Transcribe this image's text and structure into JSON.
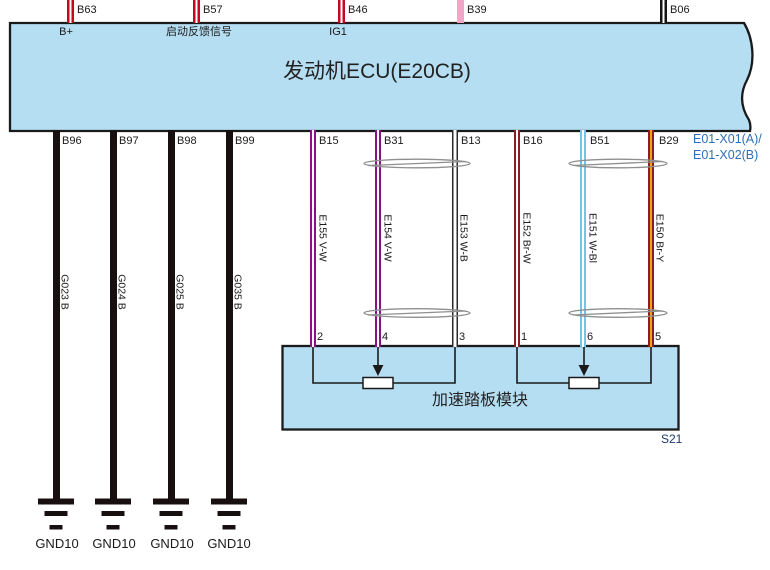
{
  "diagram": {
    "ecu": {
      "title": "发动机ECU(E20CB)",
      "connector_label": [
        "E01-X01(A)/",
        "E01-X02(B)"
      ]
    },
    "top_pins": [
      {
        "pin": "B63",
        "function": "B+",
        "wire_color": "red"
      },
      {
        "pin": "B57",
        "function": "启动反馈信号",
        "wire_color": "red"
      },
      {
        "pin": "B46",
        "function": "IG1",
        "wire_color": "red"
      },
      {
        "pin": "B39",
        "wire_color": "pink"
      },
      {
        "pin": "B06",
        "wire_color": "black-white"
      }
    ],
    "ground_circuits": [
      {
        "pin": "B96",
        "wire": "G023 B",
        "ground": "GND10"
      },
      {
        "pin": "B97",
        "wire": "G024 B",
        "ground": "GND10"
      },
      {
        "pin": "B98",
        "wire": "G025 B",
        "ground": "GND10"
      },
      {
        "pin": "B99",
        "wire": "G035 B",
        "ground": "GND10"
      }
    ],
    "pedal_circuits": [
      {
        "pin": "B15",
        "wire": "E155 V-W",
        "module_pin": "2"
      },
      {
        "pin": "B31",
        "wire": "E154 V-W",
        "module_pin": "4"
      },
      {
        "pin": "B13",
        "wire": "E153 W-B",
        "module_pin": "3"
      },
      {
        "pin": "B16",
        "wire": "E152 Br-W",
        "module_pin": "1"
      },
      {
        "pin": "B51",
        "wire": "E151 W-Bl",
        "module_pin": "6"
      },
      {
        "pin": "B29",
        "wire": "E150 Br-Y",
        "module_pin": "5"
      }
    ],
    "twisted_pairs": [
      "E154/E153",
      "E151/E150"
    ],
    "module": {
      "title": "加速踏板模块",
      "ref": "S21"
    },
    "colors": {
      "box_fill": "#b5def2",
      "box_border": "#1a1a1a",
      "wire_red": "#c40821",
      "wire_pink": "#f0a6c4",
      "wire_black": "#181010",
      "wire_violet": "#8a1088",
      "wire_brown": "#8e1c26",
      "wire_lightblue": "#70c5e6",
      "wire_yellow": "#eda411",
      "label_blue": "#2e6fb7",
      "label_navy": "#1f3a6e"
    }
  }
}
